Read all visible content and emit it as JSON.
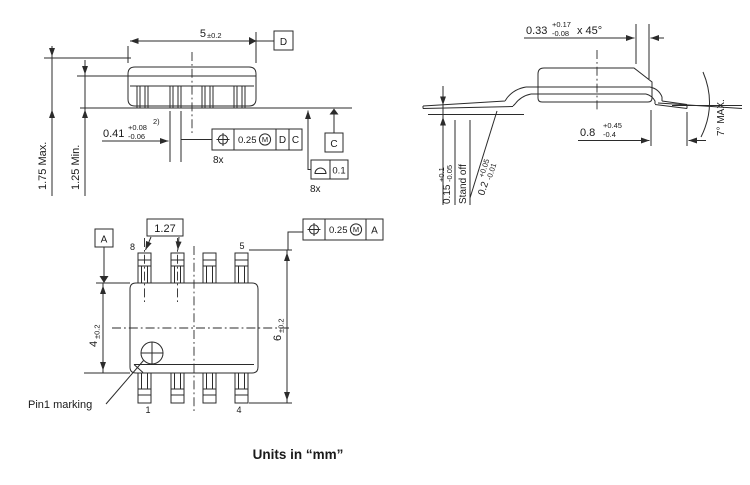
{
  "footer": {
    "units_note": "Units in “mm”"
  },
  "front_view": {
    "dim_body_length": {
      "value": "5",
      "tol": "±0.2"
    },
    "dim_height_max": "1.75 Max.",
    "dim_height_min": "1.25 Min.",
    "dim_lead_width": {
      "value": "0.41",
      "tol_plus": "+0.08",
      "tol_minus": "-0.06",
      "note": "2)"
    },
    "fcf_lead_position": {
      "tolerance": "0.25",
      "modifier": "M",
      "datum_1": "D",
      "datum_2": "C",
      "count": "8x"
    },
    "fcf_coplanarity": {
      "tolerance": "0.1",
      "count": "8x"
    },
    "datum_d_label": "D",
    "datum_c_label": "C"
  },
  "side_view": {
    "dim_chamfer": {
      "value": "0.33",
      "tol_plus": "+0.17",
      "tol_minus": "-0.08",
      "suffix": "x 45°"
    },
    "dim_foot_length": {
      "value": "0.8",
      "tol_plus": "+0.45",
      "tol_minus": "-0.4"
    },
    "lead_angle": "7° MAX.",
    "dim_standoff": {
      "value": "0.15",
      "tol_plus": "+0.1",
      "tol_minus": "-0.05",
      "label": "Stand off"
    },
    "dim_lead_thickness": {
      "value": "0.2",
      "tol_plus": "+0.05",
      "tol_minus": "-0.01"
    }
  },
  "top_view": {
    "dim_pitch": "1.27",
    "datum_a_label": "A",
    "dim_body_width": {
      "value": "4",
      "tol": "±0.2"
    },
    "dim_lead_span": {
      "value": "6",
      "tol": "±0.2"
    },
    "fcf_pin_position": {
      "tolerance": "0.25",
      "modifier": "M",
      "datum_1": "A"
    },
    "pins": {
      "top_left": "8",
      "top_right": "5",
      "bottom_left": "1",
      "bottom_right": "4"
    },
    "pin1_label": "Pin1 marking"
  }
}
